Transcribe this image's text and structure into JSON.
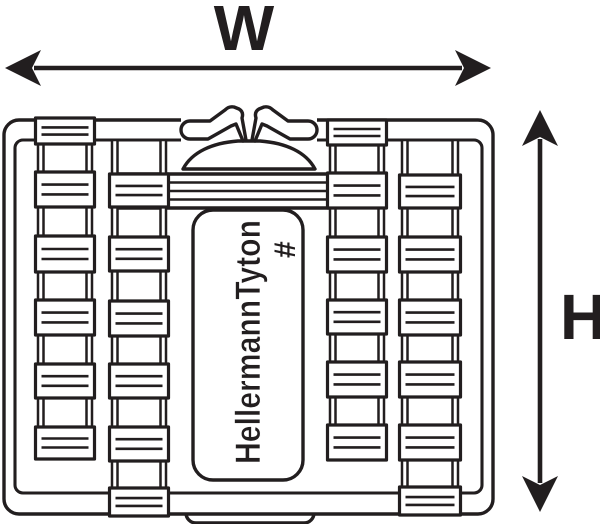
{
  "diagram_type": "product_dimension_drawing",
  "dimensions": {
    "width_label": "W",
    "height_label": "H"
  },
  "device": {
    "brand_text": "HellermannTyton",
    "logo_mark": "#"
  },
  "colors": {
    "line": "#221e1f",
    "background": "#ffffff"
  }
}
